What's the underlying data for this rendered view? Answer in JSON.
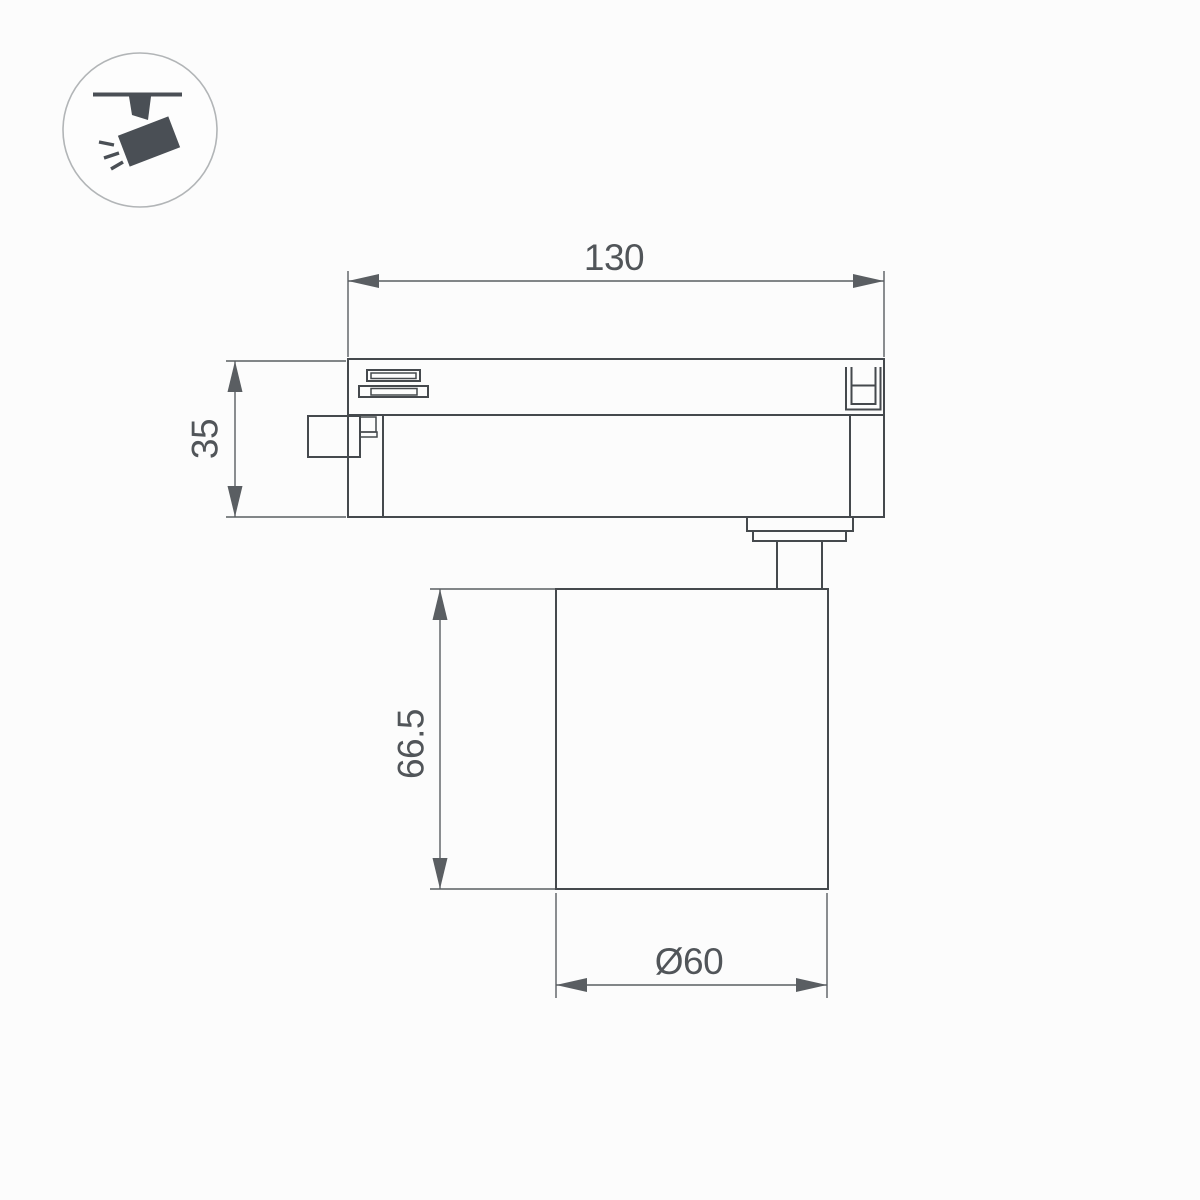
{
  "colors": {
    "background": "#fcfcfc",
    "object_line": "#45494d",
    "dimension_line": "#5a5e62",
    "dimension_text": "#515559",
    "icon_fill": "#4a4f55",
    "icon_circle_stroke": "#b2b5b7"
  },
  "icon": {
    "name": "track-spotlight"
  },
  "dimensions": {
    "track_adapter_width": "130",
    "track_adapter_height": "35",
    "lamp_body_height": "66.5",
    "lamp_body_diameter": "Ø60"
  }
}
